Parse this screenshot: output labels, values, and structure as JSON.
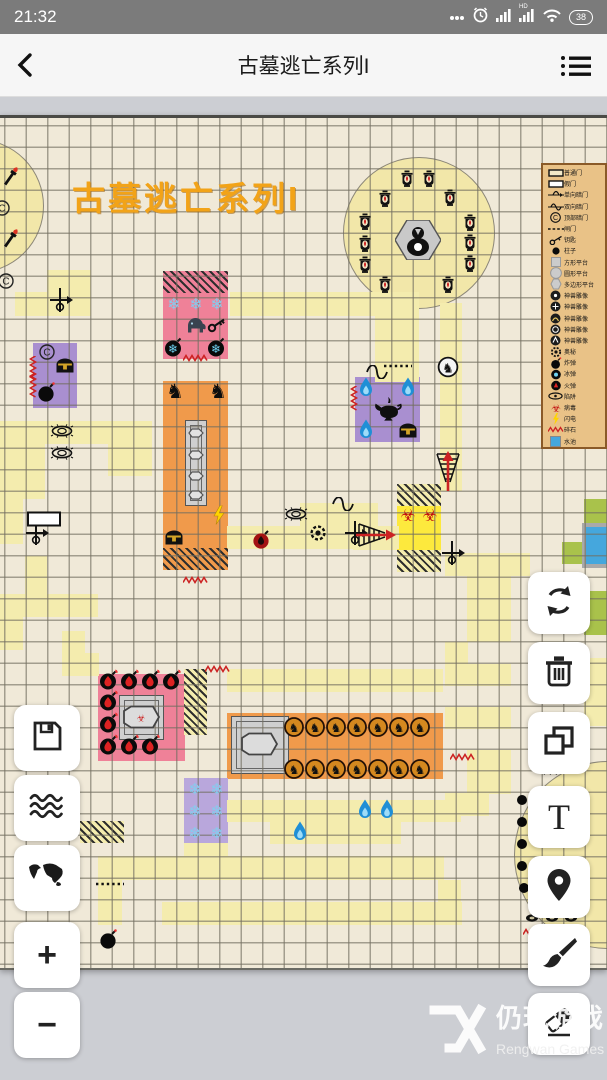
{
  "status_bar": {
    "time": "21:32",
    "battery": "38",
    "hd_label": "HD"
  },
  "header": {
    "title": "古墓逃亡系列I"
  },
  "map": {
    "top": 115,
    "title_overlay": "古墓逃亡系列I",
    "colors": {
      "bg": "#f0e9d8",
      "tile": "#f4ecae",
      "pink": "#ef8198",
      "orange": "#f09a4b",
      "purple": "#a98fd0",
      "purple2": "#b9a7dc",
      "bright_yellow": "#fde93d",
      "green": "#a9c24b",
      "water": "#45a7dd",
      "gray_platform": "#cfcfcf",
      "title_orange": "#f2a318"
    },
    "circles": [
      {
        "cx": -24,
        "cy": 202,
        "r": 66
      },
      {
        "cx": 418,
        "cy": 229,
        "r": 75
      },
      {
        "cx": 607,
        "cy": 851,
        "r": 93
      }
    ],
    "rooms": [
      {
        "x": 163,
        "y": 268,
        "w": 65,
        "h": 88,
        "f": "#ef8198"
      },
      {
        "x": 163,
        "y": 378,
        "w": 65,
        "h": 189,
        "f": "#f09a4b"
      },
      {
        "x": 33,
        "y": 340,
        "w": 44,
        "h": 65,
        "f": "#a98fd0"
      },
      {
        "x": 355,
        "y": 374,
        "w": 65,
        "h": 65,
        "f": "#a98fd0"
      },
      {
        "x": 397,
        "y": 503,
        "w": 44,
        "h": 44,
        "f": "#fde93d"
      },
      {
        "x": 584,
        "y": 496,
        "w": 23,
        "h": 65,
        "f": "#a9c24b"
      },
      {
        "x": 562,
        "y": 539,
        "w": 22,
        "h": 22,
        "f": "#a9c24b"
      },
      {
        "x": 584,
        "y": 588,
        "w": 23,
        "h": 44,
        "f": "#a9c24b"
      },
      {
        "x": 582,
        "y": 520,
        "w": 25,
        "h": 45,
        "f": "#a9a9a9"
      },
      {
        "x": 586,
        "y": 524,
        "w": 21,
        "h": 37,
        "f": "#45a7dd"
      },
      {
        "x": 98,
        "y": 671,
        "w": 87,
        "h": 87,
        "f": "#ef8198"
      },
      {
        "x": 227,
        "y": 710,
        "w": 216,
        "h": 66,
        "f": "#f09a4b"
      },
      {
        "x": 184,
        "y": 775,
        "w": 44,
        "h": 66,
        "f": "#b9a7dc"
      }
    ],
    "platforms": [
      {
        "x": 185,
        "y": 417,
        "w": 22,
        "h": 86
      },
      {
        "x": 119,
        "y": 692,
        "w": 45,
        "h": 45
      },
      {
        "x": 231,
        "y": 713,
        "w": 58,
        "h": 58
      }
    ],
    "hatched": [
      {
        "x": 163,
        "y": 268,
        "w": 65,
        "h": 22,
        "b": "#ef8198"
      },
      {
        "x": 163,
        "y": 545,
        "w": 65,
        "h": 22,
        "b": "#f09a4b"
      },
      {
        "x": 397,
        "y": 481,
        "w": 44,
        "h": 22,
        "b": "#f4ecae"
      },
      {
        "x": 397,
        "y": 547,
        "w": 44,
        "h": 22,
        "b": "#f4ecae"
      },
      {
        "x": 184,
        "y": 666,
        "w": 23,
        "h": 66,
        "b": "#f4ecae"
      },
      {
        "x": 80,
        "y": 818,
        "w": 44,
        "h": 22,
        "b": "#f4ecae"
      }
    ],
    "tiles": [
      [
        47,
        267,
        44,
        23
      ],
      [
        15,
        289,
        76,
        24
      ],
      [
        230,
        289,
        148,
        24
      ],
      [
        375,
        289,
        44,
        90
      ],
      [
        440,
        300,
        22,
        188
      ],
      [
        0,
        418,
        152,
        23
      ],
      [
        0,
        441,
        45,
        55
      ],
      [
        108,
        441,
        44,
        32
      ],
      [
        0,
        496,
        23,
        45
      ],
      [
        300,
        500,
        78,
        23
      ],
      [
        300,
        523,
        99,
        23
      ],
      [
        227,
        523,
        77,
        23
      ],
      [
        353,
        524,
        44,
        23
      ],
      [
        25,
        553,
        22,
        40
      ],
      [
        0,
        591,
        98,
        23
      ],
      [
        0,
        614,
        23,
        33
      ],
      [
        62,
        628,
        23,
        45
      ],
      [
        77,
        650,
        22,
        23
      ],
      [
        227,
        666,
        216,
        23
      ],
      [
        445,
        550,
        85,
        23
      ],
      [
        467,
        573,
        44,
        66
      ],
      [
        445,
        639,
        23,
        44
      ],
      [
        467,
        661,
        44,
        22
      ],
      [
        445,
        704,
        66,
        22
      ],
      [
        467,
        747,
        44,
        44
      ],
      [
        445,
        790,
        44,
        23
      ],
      [
        584,
        655,
        23,
        68
      ],
      [
        227,
        797,
        234,
        22
      ],
      [
        270,
        819,
        131,
        22
      ],
      [
        184,
        840,
        44,
        23
      ],
      [
        98,
        853,
        346,
        24
      ],
      [
        98,
        877,
        24,
        45
      ],
      [
        438,
        877,
        23,
        45
      ],
      [
        162,
        899,
        300,
        23
      ]
    ],
    "icons": [
      [
        "torch",
        10,
        174
      ],
      [
        "torch",
        10,
        236
      ],
      [
        "copyright",
        2,
        205
      ],
      [
        "lantern",
        407,
        176
      ],
      [
        "lantern",
        429,
        176
      ],
      [
        "lantern",
        385,
        196
      ],
      [
        "lantern",
        450,
        195
      ],
      [
        "lantern",
        365,
        219
      ],
      [
        "lantern",
        470,
        220
      ],
      [
        "lantern",
        365,
        241
      ],
      [
        "lantern",
        470,
        240
      ],
      [
        "lantern",
        365,
        262
      ],
      [
        "lantern",
        470,
        261
      ],
      [
        "lantern",
        385,
        282
      ],
      [
        "lantern",
        448,
        282
      ],
      [
        "monkey",
        418,
        237
      ],
      [
        "copyright",
        6,
        278
      ],
      [
        "copyright",
        47,
        349
      ],
      [
        "crossarrow",
        60,
        297
      ],
      [
        "crossarrow",
        36,
        530
      ],
      [
        "crossarrow",
        355,
        530
      ],
      [
        "crossarrow",
        452,
        550
      ],
      [
        "doorw",
        44,
        516
      ],
      [
        "scurve",
        343,
        501
      ],
      [
        "scurve",
        377,
        369
      ],
      [
        "zigh",
        196,
        355
      ],
      [
        "zigh",
        218,
        666
      ],
      [
        "zigh",
        196,
        577
      ],
      [
        "zigh",
        463,
        754
      ],
      [
        "zigh",
        536,
        929
      ],
      [
        "zigv",
        33,
        366
      ],
      [
        "zigv",
        33,
        383
      ],
      [
        "zigv",
        354,
        396
      ],
      [
        "dots",
        110,
        881
      ],
      [
        "dots",
        398,
        363
      ],
      [
        "snow",
        174,
        301
      ],
      [
        "snow",
        196,
        301
      ],
      [
        "snow",
        217,
        301
      ],
      [
        "elephant",
        195,
        322
      ],
      [
        "key",
        217,
        322
      ],
      [
        "ibomb",
        174,
        344
      ],
      [
        "ibomb",
        217,
        344
      ],
      [
        "chest",
        65,
        362
      ],
      [
        "bomb",
        47,
        389
      ],
      [
        "eye",
        62,
        428
      ],
      [
        "eye",
        62,
        450
      ],
      [
        "eye",
        296,
        511
      ],
      [
        "gear",
        318,
        530
      ],
      [
        "griffin",
        175,
        388
      ],
      [
        "griffin",
        218,
        388
      ],
      [
        "plinth",
        196,
        430
      ],
      [
        "plinth",
        196,
        452
      ],
      [
        "plinth",
        196,
        473
      ],
      [
        "plinth",
        196,
        492
      ],
      [
        "bolt",
        219,
        512
      ],
      [
        "chest",
        174,
        534
      ],
      [
        "rbomb",
        262,
        536
      ],
      [
        "bio",
        408,
        512
      ],
      [
        "bio",
        430,
        512
      ],
      [
        "ladderR",
        376,
        532
      ],
      [
        "ladderU",
        448,
        468
      ],
      [
        "knightc",
        448,
        364
      ],
      [
        "bflame",
        366,
        384
      ],
      [
        "bflame",
        408,
        384
      ],
      [
        "bflame",
        366,
        426
      ],
      [
        "lamp",
        387,
        406
      ],
      [
        "chest",
        408,
        427
      ],
      [
        "fbomb",
        109,
        677
      ],
      [
        "fbomb",
        130,
        677
      ],
      [
        "fbomb",
        151,
        677
      ],
      [
        "fbomb",
        172,
        677
      ],
      [
        "fbomb",
        109,
        698
      ],
      [
        "fbomb",
        109,
        720
      ],
      [
        "fbomb",
        109,
        742
      ],
      [
        "fbomb",
        130,
        742
      ],
      [
        "fbomb",
        151,
        742
      ],
      [
        "coffinP",
        141,
        714
      ],
      [
        "knightb",
        294,
        724
      ],
      [
        "knightb",
        315,
        724
      ],
      [
        "knightb",
        336,
        724
      ],
      [
        "knightb",
        357,
        724
      ],
      [
        "knightb",
        378,
        724
      ],
      [
        "knightb",
        399,
        724
      ],
      [
        "knightb",
        420,
        724
      ],
      [
        "knightb",
        294,
        766
      ],
      [
        "knightb",
        315,
        766
      ],
      [
        "knightb",
        336,
        766
      ],
      [
        "knightb",
        357,
        766
      ],
      [
        "knightb",
        378,
        766
      ],
      [
        "knightb",
        399,
        766
      ],
      [
        "knightb",
        420,
        766
      ],
      [
        "coffin",
        259,
        741
      ],
      [
        "snow",
        195,
        786
      ],
      [
        "snow",
        217,
        786
      ],
      [
        "snow",
        195,
        808
      ],
      [
        "snow",
        217,
        808
      ],
      [
        "snow",
        195,
        830
      ],
      [
        "snow",
        217,
        830
      ],
      [
        "bflame",
        365,
        806
      ],
      [
        "bflame",
        387,
        806
      ],
      [
        "bflame",
        300,
        828
      ],
      [
        "pillar",
        522,
        797
      ],
      [
        "pillar",
        522,
        819
      ],
      [
        "pillar",
        522,
        841
      ],
      [
        "pillar",
        522,
        863
      ],
      [
        "pillar",
        524,
        885
      ],
      [
        "hatchm",
        553,
        767
      ],
      [
        "smallblob",
        532,
        915
      ],
      [
        "smallblob",
        552,
        915
      ],
      [
        "smallblob",
        571,
        915
      ],
      [
        "bomb",
        109,
        936
      ]
    ]
  },
  "legend": {
    "items": [
      {
        "icon": "doorO",
        "label": "普通门"
      },
      {
        "icon": "doorF",
        "label": "假门"
      },
      {
        "icon": "sc1",
        "label": "单向暗门"
      },
      {
        "icon": "sc2",
        "label": "双向暗门"
      },
      {
        "icon": "cC",
        "label": "顶部暗门"
      },
      {
        "icon": "dash",
        "label": "闸门"
      },
      {
        "icon": "keyL",
        "label": "钥匙"
      },
      {
        "icon": "dot",
        "label": "柱子"
      },
      {
        "icon": "sq",
        "label": "方形平台"
      },
      {
        "icon": "circ",
        "label": "圆形平台"
      },
      {
        "icon": "poly",
        "label": "多边形平台"
      },
      {
        "icon": "st1",
        "label": "神兽雕像"
      },
      {
        "icon": "st2",
        "label": "神兽雕像"
      },
      {
        "icon": "st3",
        "label": "神兽雕像"
      },
      {
        "icon": "st4",
        "label": "神兽雕像"
      },
      {
        "icon": "st5",
        "label": "神兽雕像"
      },
      {
        "icon": "gearL",
        "label": "奥秘"
      },
      {
        "icon": "bombL",
        "label": "炸弹"
      },
      {
        "icon": "ibombL",
        "label": "冰弹"
      },
      {
        "icon": "fbombL",
        "label": "火弹"
      },
      {
        "icon": "eyeL",
        "label": "陷阱"
      },
      {
        "icon": "bioL",
        "label": "病毒"
      },
      {
        "icon": "boltL",
        "label": "闪电"
      },
      {
        "icon": "zigL",
        "label": "碎石"
      },
      {
        "icon": "waterL",
        "label": "水池"
      }
    ]
  },
  "buttons": {
    "left": [
      {
        "name": "save",
        "y": 705
      },
      {
        "name": "waves",
        "y": 775
      },
      {
        "name": "world",
        "y": 845
      },
      {
        "name": "zoom-in",
        "y": 922,
        "glyph": "+"
      },
      {
        "name": "zoom-out",
        "y": 992,
        "glyph": "−"
      }
    ],
    "right": [
      {
        "name": "rotate",
        "y": 572
      },
      {
        "name": "delete",
        "y": 642
      },
      {
        "name": "copy",
        "y": 712
      },
      {
        "name": "text",
        "y": 786,
        "glyph": "T"
      },
      {
        "name": "location",
        "y": 856
      },
      {
        "name": "brush",
        "y": 924
      },
      {
        "name": "eraser",
        "y": 993
      }
    ]
  },
  "watermark": {
    "cn": "仍玩游戏",
    "en": "Rengwan Games"
  }
}
